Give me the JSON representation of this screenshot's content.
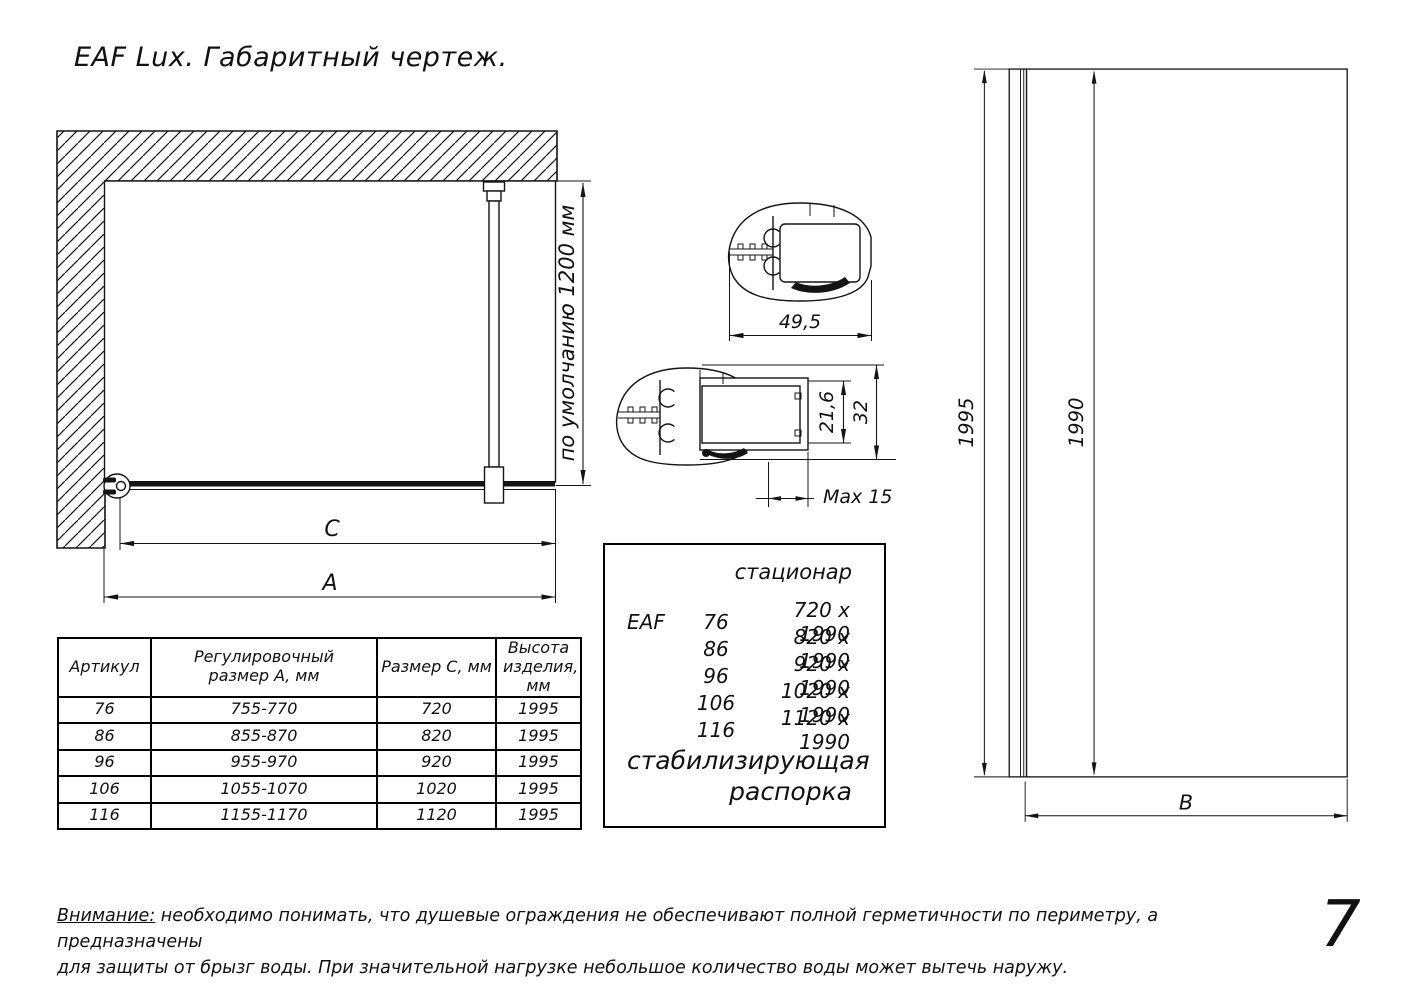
{
  "page": {
    "title": "EAF Lux. Габаритный чертеж.",
    "number": "7"
  },
  "plan_view": {
    "stabilizer_length_label": "по умолчанию 1200 мм",
    "dim_c_label": "C",
    "dim_a_label": "A"
  },
  "profile_sections": {
    "wall_profile_width": "49,5",
    "glass_insert_depth": "21,6",
    "profile_height": "32",
    "max_adjustment": "Max 15"
  },
  "front_view": {
    "total_height": "1995",
    "glass_height": "1990",
    "dim_b_label": "B"
  },
  "size_table": {
    "headers": [
      "Артикул",
      "Регулировочный размер А, мм",
      "Размер С, мм",
      "Высота изделия, мм"
    ],
    "rows": [
      [
        "76",
        "755-770",
        "720",
        "1995"
      ],
      [
        "86",
        "855-870",
        "820",
        "1995"
      ],
      [
        "96",
        "955-970",
        "920",
        "1995"
      ],
      [
        "106",
        "1055-1070",
        "1020",
        "1995"
      ],
      [
        "116",
        "1155-1170",
        "1120",
        "1995"
      ]
    ]
  },
  "spec_box": {
    "type_label": "стационар",
    "series": "EAF",
    "models": [
      {
        "code": "76",
        "size": "720 x 1990"
      },
      {
        "code": "86",
        "size": "820 x 1990"
      },
      {
        "code": "96",
        "size": "920 x 1990"
      },
      {
        "code": "106",
        "size": "1020 x 1990"
      },
      {
        "code": "116",
        "size": "1120 x 1990"
      }
    ],
    "strut_label_line1": "стабилизирующая",
    "strut_label_line2": "распорка"
  },
  "note": {
    "label": "Внимание:",
    "text_line1": " необходимо понимать, что душевые ограждения не обеспечивают полной герметичности по периметру, а предназначены",
    "text_line2": "для защиты от брызг воды. При значительной нагрузке небольшое количество воды может вытечь наружу."
  }
}
